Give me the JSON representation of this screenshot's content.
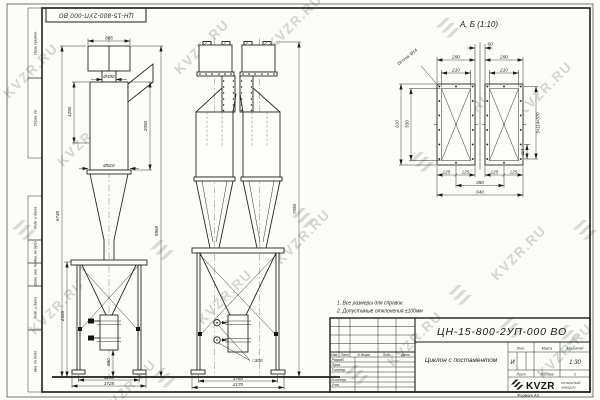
{
  "doc": {
    "number": "ЦН-15-800-2УП-000 ВО",
    "stamp": "ЦН-15-800-2УП-000 ВО",
    "name": "Циклон с постаментом",
    "lit": "И",
    "scale": "1:30",
    "sheets_value": "1",
    "format": "Формат  А3"
  },
  "frame": {
    "fields": [
      "Перв. примен.",
      "Справ. №",
      "Подп. и дата",
      "Инв. № дубл.",
      "Взам. инв. №",
      "Подп. и дата",
      "Инв. № подл."
    ]
  },
  "watermark": {
    "text": "KVZR.RU"
  },
  "notes": {
    "n1": "1.  Все размеры для справок.",
    "n2": "2.  Допустимые отклонения ±100мм"
  },
  "titleblock": {
    "h_izm": "Изм.",
    "h_list": "Лист",
    "h_ndoc": "N докум.",
    "h_podp": "Подп.",
    "h_data": "Дата",
    "r_razrab": "Разраб.",
    "r_prov": "Пров.",
    "r_tkontr": "Т.контр.",
    "r_nkontr": "Н.контр.",
    "r_utv": "Утв.",
    "lit_label": "Лит.",
    "massa_label": "Масса",
    "masshtab_label": "Масштаб",
    "list_label": "Лист",
    "listov_label": "Листов",
    "company_name": "KVZR",
    "company_sub1": "КОТЕЛЬНЫЙ",
    "company_sub2": "ЗАВОД.РУ"
  },
  "views": {
    "front": {
      "dims": {
        "top_width": "885",
        "neck_dia": "Ø490",
        "inlet_height": "1290",
        "body_height": "2050",
        "body_dia": "Ø810",
        "total_height": "5865",
        "overall_height": "6745",
        "pedestal_height": "2365",
        "outlet_height": "550",
        "base_span": "1200",
        "base_width": "1725"
      }
    },
    "side": {
      "dims": {
        "overall_height": "7050",
        "outlet_square": "□300",
        "base_span": "1760",
        "base_width": "2170"
      }
    },
    "detail": {
      "title": "А, Б  (1:10)",
      "holes_note": "28 отв. Ø14",
      "dims": {
        "gap": "60",
        "panel_w": "290",
        "holes_w": "210",
        "panel_h": "610",
        "holes_h": "530",
        "pitch": "5×114=570",
        "pitch1": "114",
        "q": "125",
        "centers": "350",
        "overall": "640"
      }
    }
  }
}
